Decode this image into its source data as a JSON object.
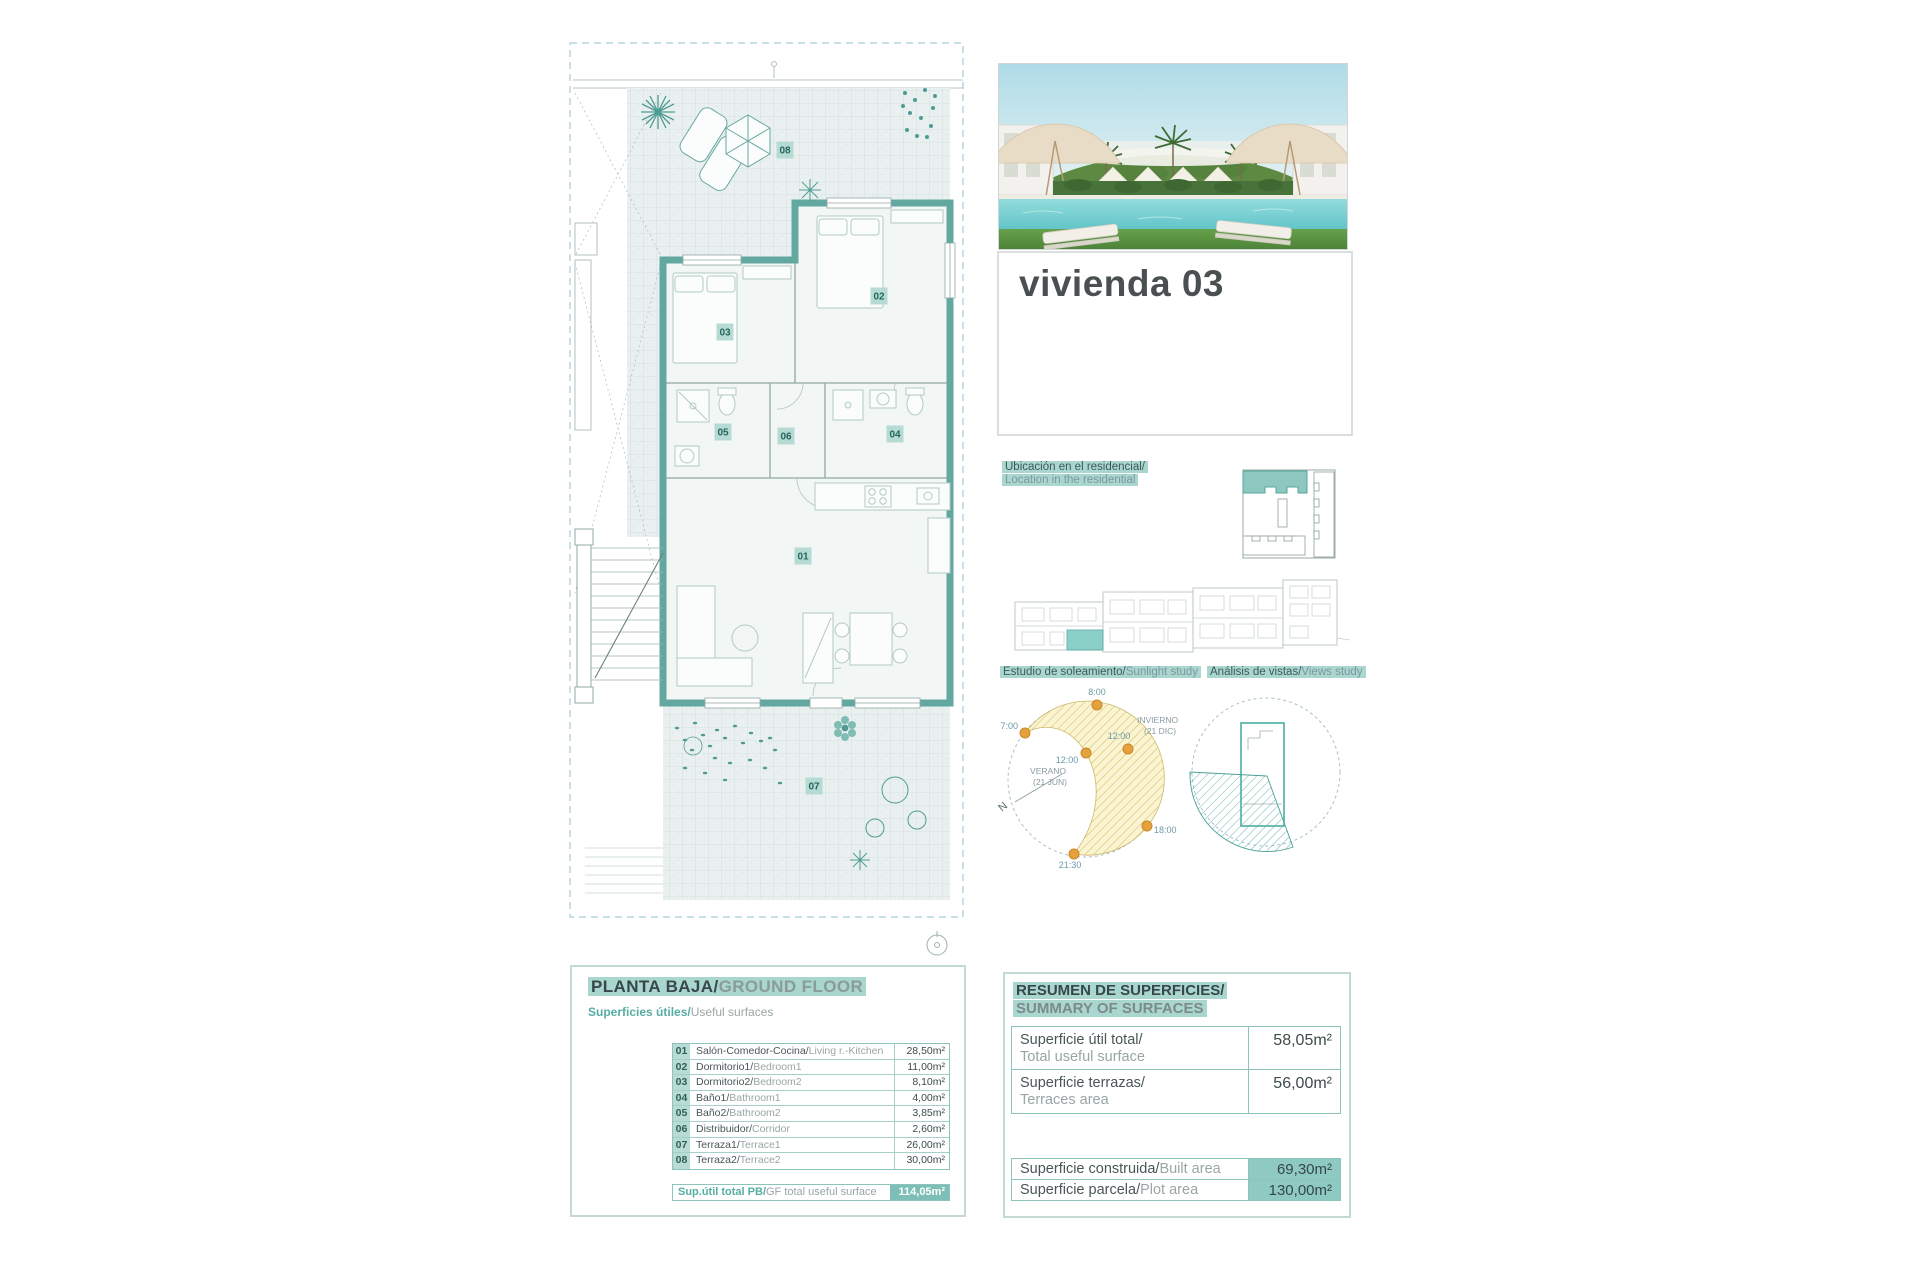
{
  "hero": {
    "title": "vivienda 03"
  },
  "location": {
    "line_es": "Ubicación en el residencial/",
    "line_en": "Location in the residential"
  },
  "sunlight_study": {
    "label_es": "Estudio de soleamiento/",
    "label_en": "Sunlight study",
    "north": "N",
    "season_summer": "VERANO",
    "season_summer_date": "(21 JUN)",
    "season_winter": "INVIERNO",
    "season_winter_date": "(21 DIC)",
    "time_0800": "8:00",
    "time_0700": "7:00",
    "time_1200_summer": "12:00",
    "time_1200_winter": "12:00",
    "time_1800": "18:00",
    "time_2130": "21:30"
  },
  "views_study": {
    "label_es": "Análisis de vistas/",
    "label_en": "Views study"
  },
  "floor_plan": {
    "labels": {
      "r01": "01",
      "r02": "02",
      "r03": "03",
      "r04": "04",
      "r05": "05",
      "r06": "06",
      "r07": "07",
      "r08": "08"
    }
  },
  "ground_floor": {
    "title_es": "PLANTA BAJA/",
    "title_en": "GROUND FLOOR",
    "subtitle_es": "Superficies útiles/",
    "subtitle_en": "Useful surfaces",
    "rows": [
      {
        "num": "01",
        "name_es": "Salón-Comedor-Cocina/",
        "name_en": "Living r.-Kitchen",
        "area": "28,50m²"
      },
      {
        "num": "02",
        "name_es": "Dormitorio1/",
        "name_en": "Bedroom1",
        "area": "11,00m²"
      },
      {
        "num": "03",
        "name_es": "Dormitorio2/",
        "name_en": "Bedroom2",
        "area": "8,10m²"
      },
      {
        "num": "04",
        "name_es": "Baño1/",
        "name_en": "Bathroom1",
        "area": "4,00m²"
      },
      {
        "num": "05",
        "name_es": "Baño2/",
        "name_en": "Bathroom2",
        "area": "3,85m²"
      },
      {
        "num": "06",
        "name_es": "Distribuidor/",
        "name_en": "Corridor",
        "area": "2,60m²"
      },
      {
        "num": "07",
        "name_es": "Terraza1/",
        "name_en": "Terrace1",
        "area": "26,00m²"
      },
      {
        "num": "08",
        "name_es": "Terraza2/",
        "name_en": "Terrace2",
        "area": "30,00m²"
      }
    ],
    "total_label_es": "Sup.útil total PB/",
    "total_label_en": "GF total useful surface",
    "total_area": "114,05m²"
  },
  "summary": {
    "title_es": "RESUMEN DE SUPERFICIES/",
    "title_en": "SUMMARY OF SURFACES",
    "rows": [
      {
        "label_es": "Superficie útil total/",
        "label_en": "Total useful surface",
        "area": "58,05m²"
      },
      {
        "label_es": "Superficie terrazas/",
        "label_en": "Terraces area",
        "area": "56,00m²"
      }
    ],
    "totals": [
      {
        "label_es": "Superficie construida/",
        "label_en": "Built area",
        "area": "69,30m²"
      },
      {
        "label_es": "Superficie parcela/",
        "label_en": "Plot area",
        "area": "130,00m²"
      }
    ]
  },
  "colors": {
    "accent_teal": "#63a8a0",
    "highlight": "#a9d6cf",
    "sun_dot": "#e5a23c",
    "hatch_yellow": "#e8d98a"
  }
}
